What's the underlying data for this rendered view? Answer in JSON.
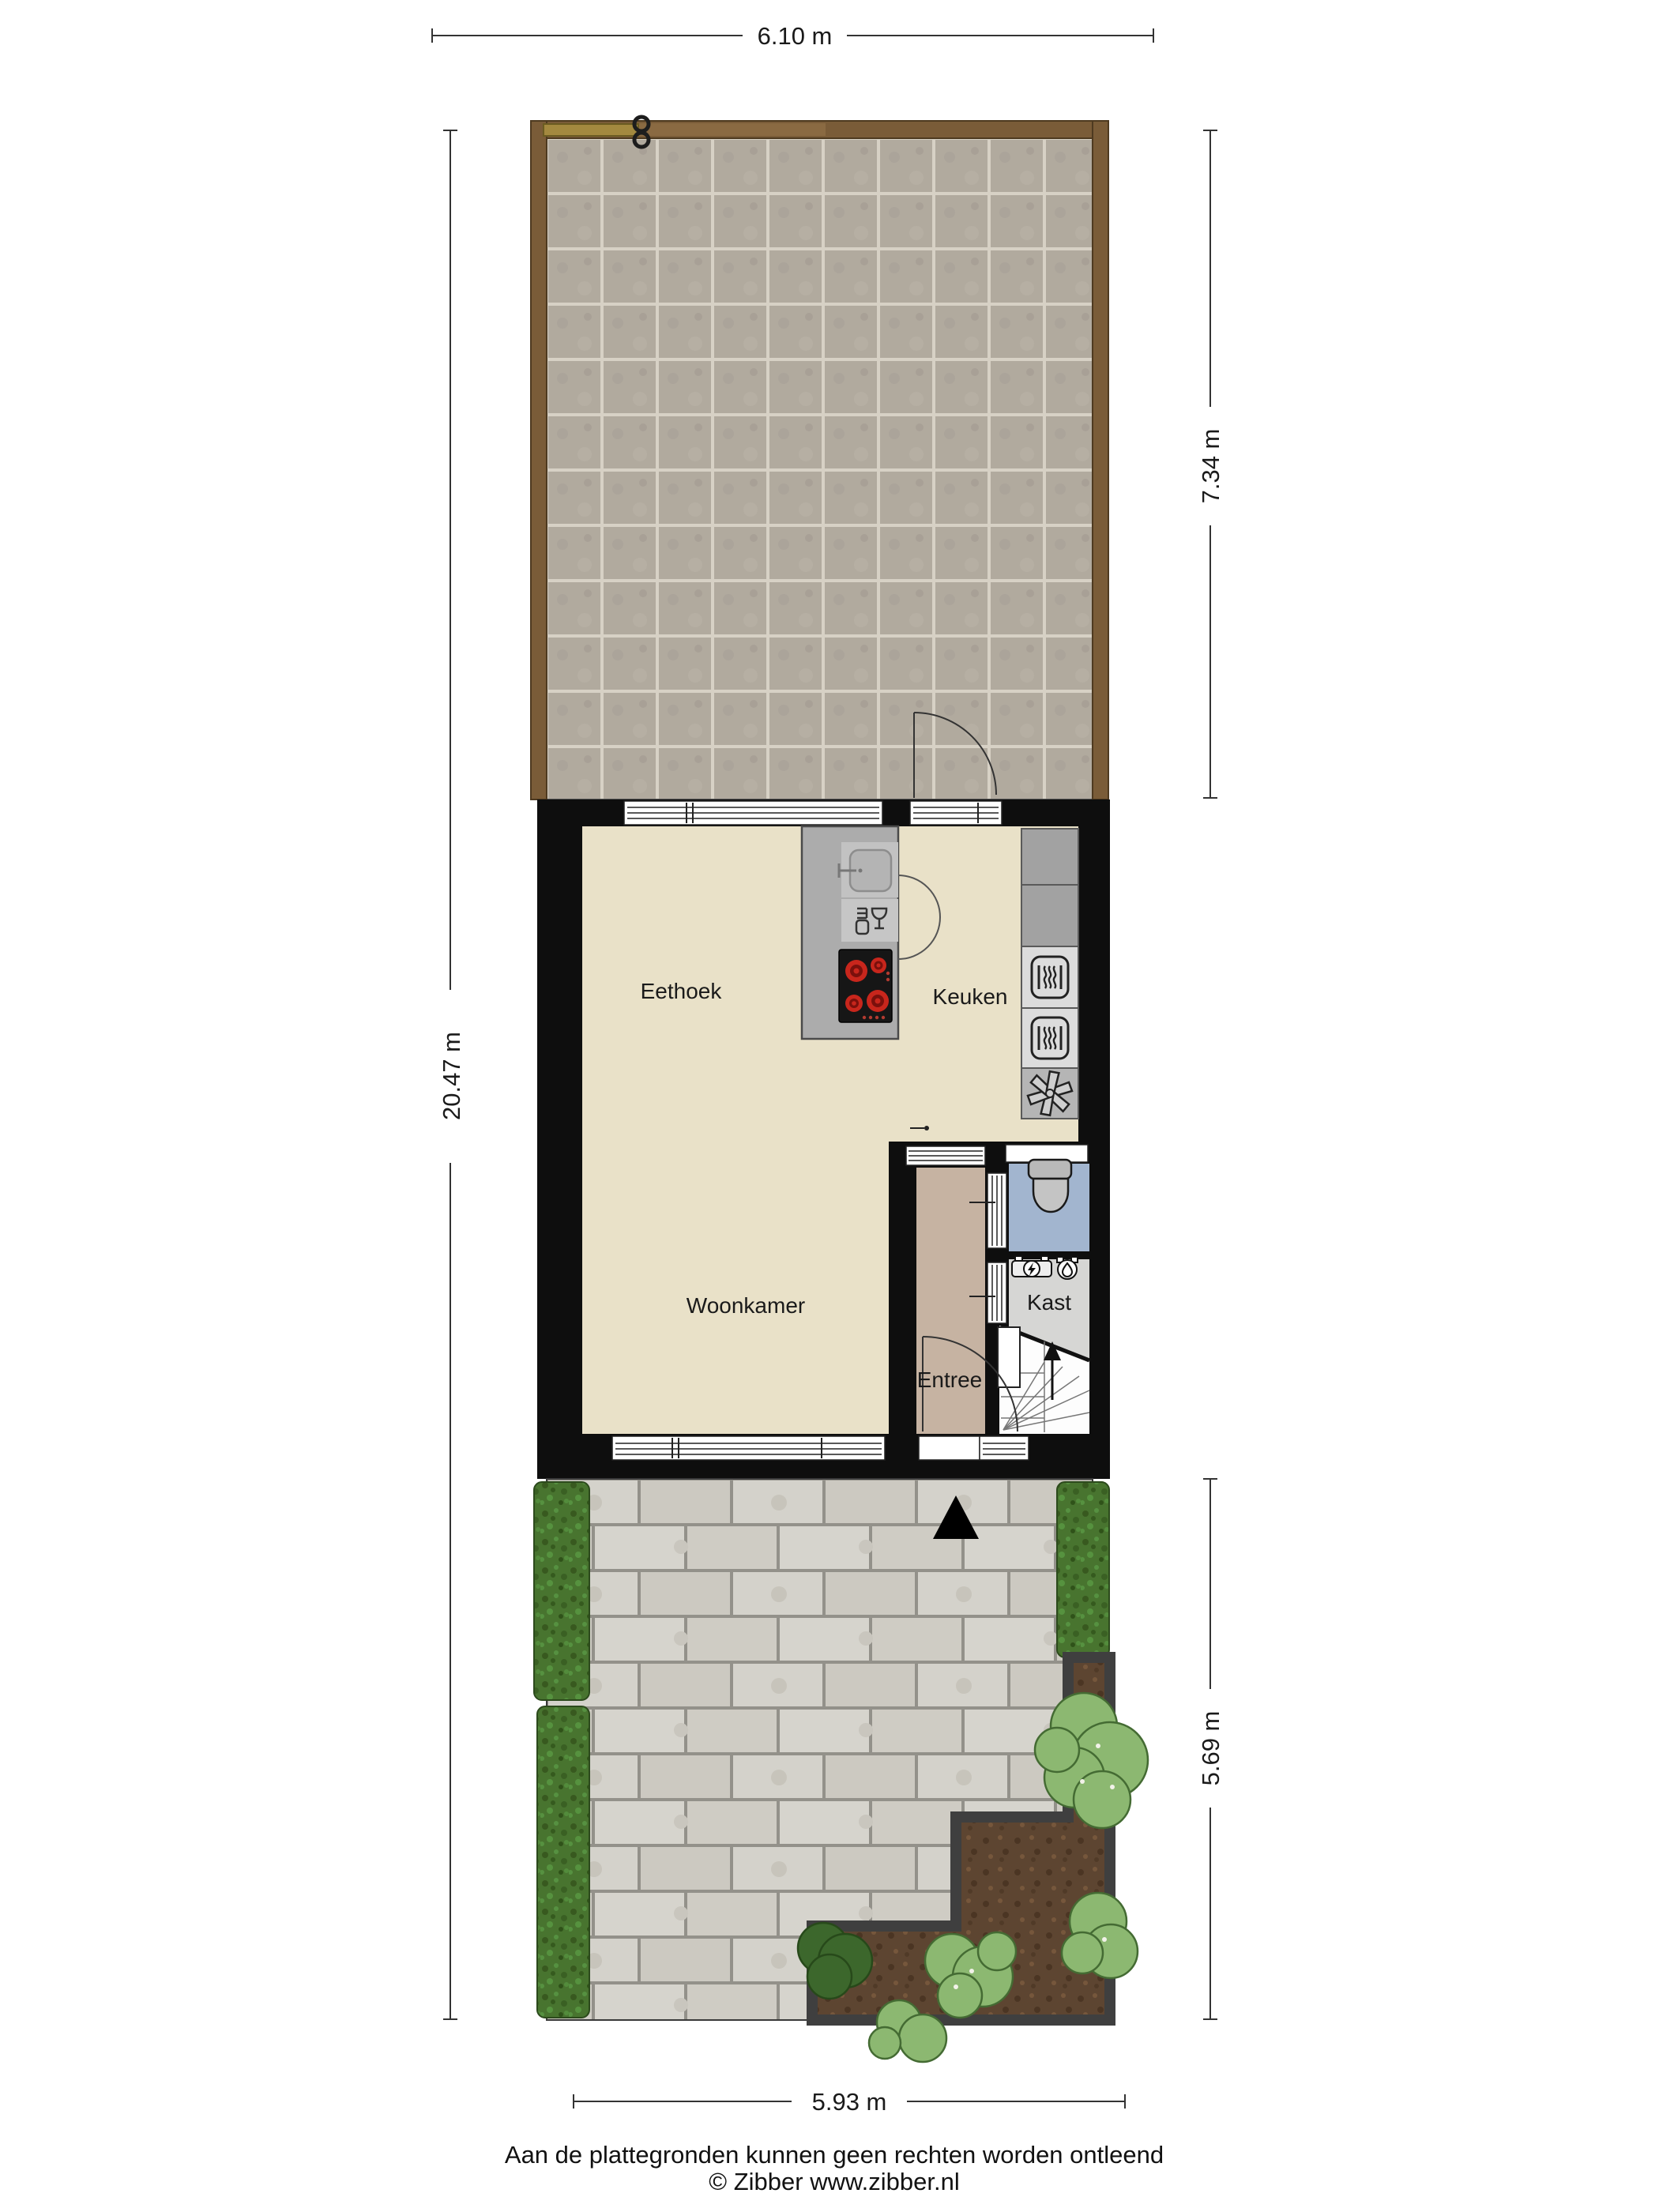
{
  "dimensions": {
    "top": "6.10 m",
    "side_left": "20.47 m",
    "side_right_top": "7.34 m",
    "side_right_bottom": "5.69 m",
    "bottom": "5.93 m"
  },
  "rooms": {
    "eethoek": {
      "label": "Eethoek"
    },
    "keuken": {
      "label": "Keuken"
    },
    "woonkamer": {
      "label": "Woonkamer"
    },
    "entree": {
      "label": "Entree"
    },
    "kast": {
      "label": "Kast"
    }
  },
  "footer": {
    "disclaimer": "Aan de plattegronden kunnen geen rechten worden ontleend",
    "credit": "© Zibber www.zibber.nl"
  },
  "colors": {
    "wall": "#0e0e0e",
    "floor_main": "#e9e1c8",
    "floor_entree": "#c6b3a2",
    "floor_kast": "#d6d6d4",
    "floor_toilet": "#a2b5cf",
    "floor_stairs": "#fdfdfd",
    "island": "#acacac",
    "counter": "#a2a2a2",
    "appliance_panel": "#dcdcdc",
    "fan_panel": "#b5b5b5",
    "cooktop": "#161616",
    "burner": "#c8261c",
    "fence_wood": "#7a5c38",
    "gate_wood": "#a3893f",
    "planter_border": "#3f3f3f",
    "bush_light": "#8cb871",
    "bush_dark": "#3c672c",
    "dim_line": "#333333"
  }
}
